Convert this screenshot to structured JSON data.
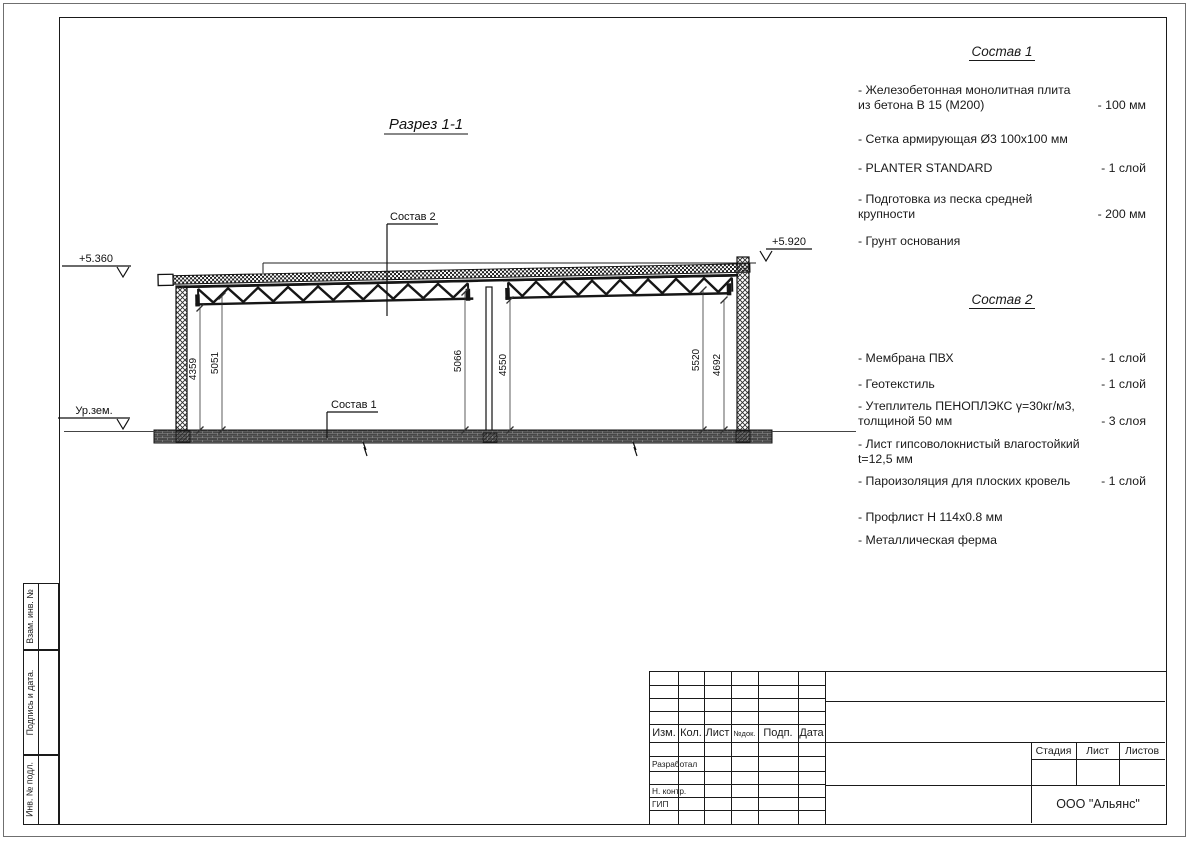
{
  "drawing": {
    "title": "Разрез 1-1",
    "elev_left": "+5.360",
    "elev_right": "+5.920",
    "ground_label": "Ур.зем.",
    "ref_sostav1": "Состав 1",
    "ref_sostav2": "Состав 2",
    "dims": [
      "4359",
      "5051",
      "5066",
      "4550",
      "5520",
      "4692"
    ]
  },
  "sostav1": {
    "title": "Состав 1",
    "items": [
      {
        "name": "- Железобетонная  монолитная плита\nиз бетона В 15 (М200)",
        "value": "- 100 мм"
      },
      {
        "name": "- Сетка армирующая Ø3 100х100 мм",
        "value": ""
      },
      {
        "name": "- PLANTER STANDARD",
        "value": "- 1  слой"
      },
      {
        "name": "- Подготовка из песка средней\nкрупности",
        "value": "- 200 мм"
      },
      {
        "name": "- Грунт основания",
        "value": ""
      }
    ]
  },
  "sostav2": {
    "title": "Состав 2",
    "items": [
      {
        "name": "- Мембрана ПВХ",
        "value": "- 1 слой"
      },
      {
        "name": "- Геотекстиль",
        "value": "- 1 слой"
      },
      {
        "name": "- Утеплитель ПЕНОПЛЭКС γ=30кг/м3,\nтолщиной 50 мм",
        "value": "- 3 слоя"
      },
      {
        "name": "- Лист гипсоволокнистый влагостойкий\nt=12,5 мм",
        "value": ""
      },
      {
        "name": "- Пароизоляция для плоских кровель",
        "value": "- 1 слой"
      },
      {
        "name": "- Профлист Н 114х0.8 мм",
        "value": ""
      },
      {
        "name": "- Металлическая ферма",
        "value": ""
      }
    ]
  },
  "stamp": {
    "header": {
      "izm": "Изм.",
      "kol": "Кол.",
      "list": "Лист",
      "ndok": "№док.",
      "podp": "Подп.",
      "data": "Дата"
    },
    "rows": {
      "razrabotal": "Разработал",
      "nkontr": "Н. контр.",
      "gip": "ГИП"
    },
    "right": {
      "stadia": "Стадия",
      "list": "Лист",
      "listov": "Листов",
      "company": "ООО \"Альянс\""
    }
  },
  "side": {
    "vzam": "Взам. инв. №",
    "podpis": "Подпись  и  дата.",
    "inv": "Инв. № подл."
  }
}
